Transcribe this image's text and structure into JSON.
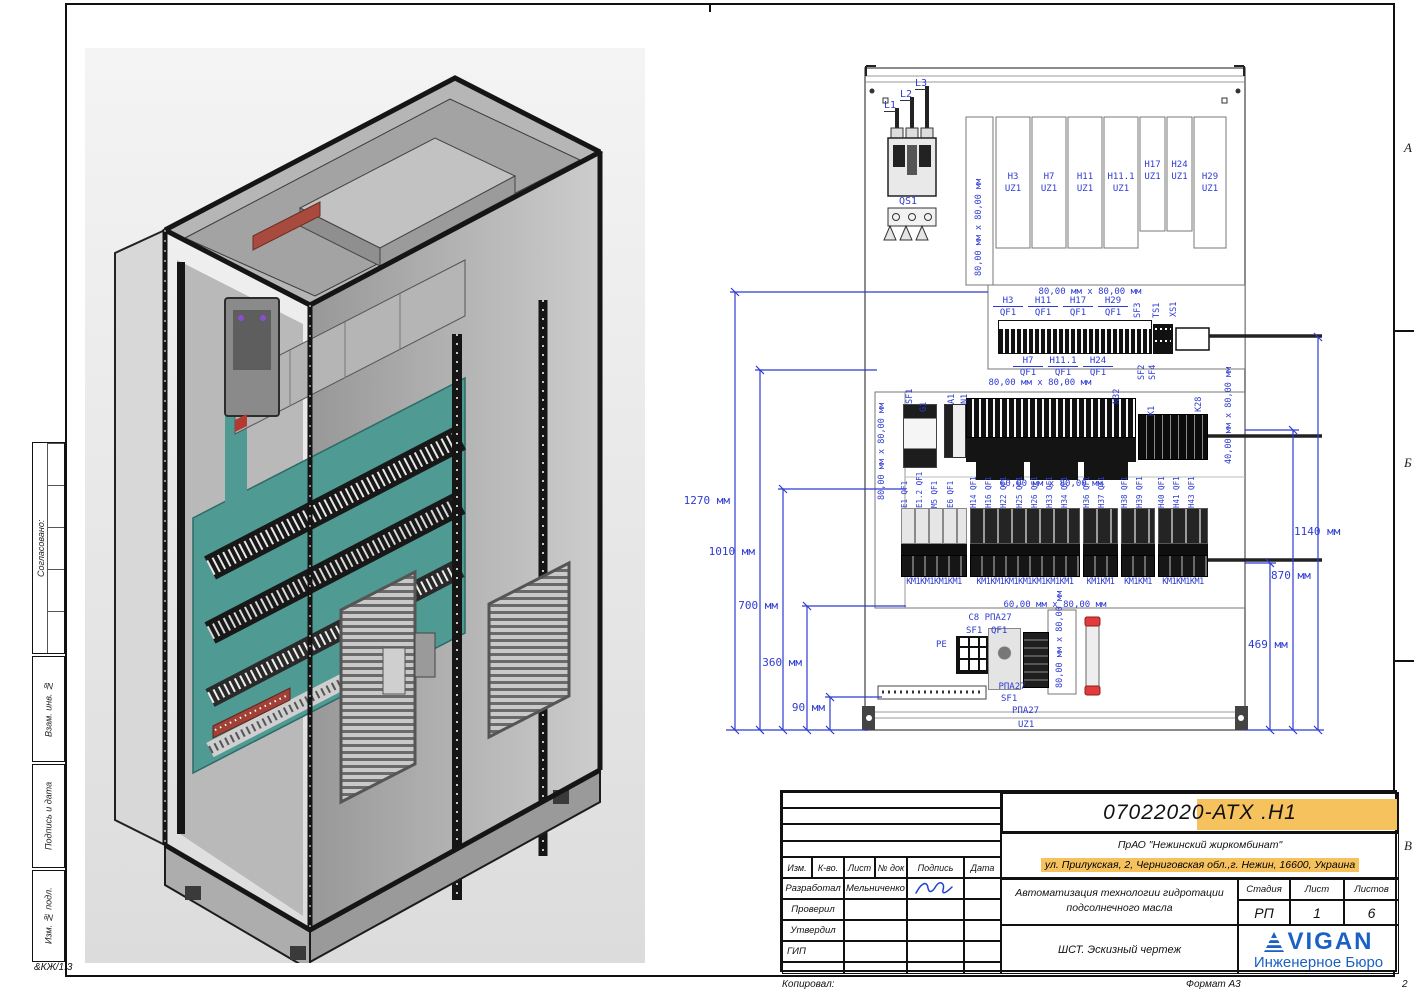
{
  "frame": {
    "zone_letters": [
      "А",
      "Б",
      "В"
    ],
    "corner_code": "&КЖ/1.3",
    "copied_label": "Копировал:",
    "format_label": "Формат А3",
    "page_number": "2"
  },
  "sidebar": {
    "approved_label": "Согласовано:",
    "vzam_label": "Взам. инв. №",
    "signdate_label": "Подпись и дата",
    "inv_label": "Изм. № подл."
  },
  "title_block": {
    "doc_number": "07022020-АТХ .Н1",
    "company": "ПрАО \"Нежинский жиркомбинат\"",
    "address": "ул. Прилукская, 2, Черниговская обл.,г. Нежин, 16600, Украина",
    "project_line1": "Автоматизация технологии гидротации",
    "project_line2": "подсолнечного масла",
    "sheet_title": "ШСТ. Эскизный чертеж",
    "stage_header": "Стадия",
    "sheet_header": "Лист",
    "sheets_header": "Листов",
    "stage": "РП",
    "sheet": "1",
    "sheets": "6",
    "cols": {
      "izm": "Изм.",
      "kvo": "К-во.",
      "list": "Лист",
      "ndok": "№ док",
      "podpis": "Подпись",
      "data": "Дата"
    },
    "rows": {
      "developed": "Разработал",
      "checked": "Проверил",
      "approved": "Утвердил",
      "gip": "ГИП"
    },
    "developer_name": "Мельниченко",
    "logo_text": "VIGAN",
    "logo_sub": "Инженерное Бюро"
  },
  "schematic": {
    "phase_labels": [
      "L1",
      "L2",
      "L3"
    ],
    "qs1_label": "QS1",
    "size_80x80": "80,00 мм x 80,00 мм",
    "size_60x80": "60,00 мм x 80,00 мм",
    "size_40x80": "40,00 мм x 80,00 мм",
    "uz1_boxes": [
      {
        "name": "H3",
        "unit": "UZ1"
      },
      {
        "name": "H7",
        "unit": "UZ1"
      },
      {
        "name": "H11",
        "unit": "UZ1"
      },
      {
        "name": "H11.1",
        "unit": "UZ1"
      },
      {
        "name": "H17",
        "unit": "UZ1"
      },
      {
        "name": "H24",
        "unit": "UZ1"
      },
      {
        "name": "H29",
        "unit": "UZ1"
      }
    ],
    "row2": {
      "qf": "QF1",
      "top_names": [
        "H3",
        "H11",
        "H17",
        "H29"
      ],
      "top_vertical": [
        "SF3",
        "TS1",
        "XS1"
      ],
      "bottom_names": [
        "H7",
        "H11.1",
        "H24"
      ],
      "bottom_vertical": [
        "SF2",
        "SF4"
      ]
    },
    "row3_labels": [
      "SF1",
      "G1",
      "A1",
      "N1",
      "N32",
      "K1",
      "K28"
    ],
    "row4_groups": [
      {
        "labels": [
          "E1 QF1",
          "E1.2 QF1",
          "M5 QF1",
          "E6 QF1"
        ],
        "km": "КМ1КМ1КМ1КМ1"
      },
      {
        "labels": [
          "H14 QF1",
          "H16 QF1",
          "H22 QF1",
          "H25 QF1",
          "H26 QF1",
          "H33 QF1",
          "H34 QF1"
        ],
        "km": "КМ1КМ1КМ1КМ1КМ1КМ1КМ1"
      },
      {
        "labels": [
          "H36 QF1",
          "H37 QF1"
        ],
        "km": "КМ1КМ1"
      },
      {
        "labels": [
          "H38 QF1",
          "H39 QF1"
        ],
        "km": "КМ1КМ1"
      },
      {
        "labels": [
          "H40 QF1",
          "H41 QF1",
          "H43 QF1"
        ],
        "km": "КМ1КМ1КМ1"
      }
    ],
    "bottom_labels": {
      "c8": "С8 РПА27",
      "sf1_top": "SF1",
      "qf1": "QF1",
      "pe": "РЕ",
      "rpa27_1": "РПА27",
      "sf1_bottom": "SF1",
      "rpa27_2": "РПА27",
      "uz1": "UZ1"
    },
    "dims_left": [
      "1270 мм",
      "1010 мм",
      "700 мм",
      "360 мм",
      "90 мм"
    ],
    "dims_right": [
      "1140 мм",
      "870 мм",
      "469 мм"
    ]
  },
  "colors": {
    "annotation_blue": "#2e3bd2",
    "highlight_orange": "#f6c25e",
    "logo_blue": "#1b60c4",
    "plate_teal": "#4f9b94"
  }
}
